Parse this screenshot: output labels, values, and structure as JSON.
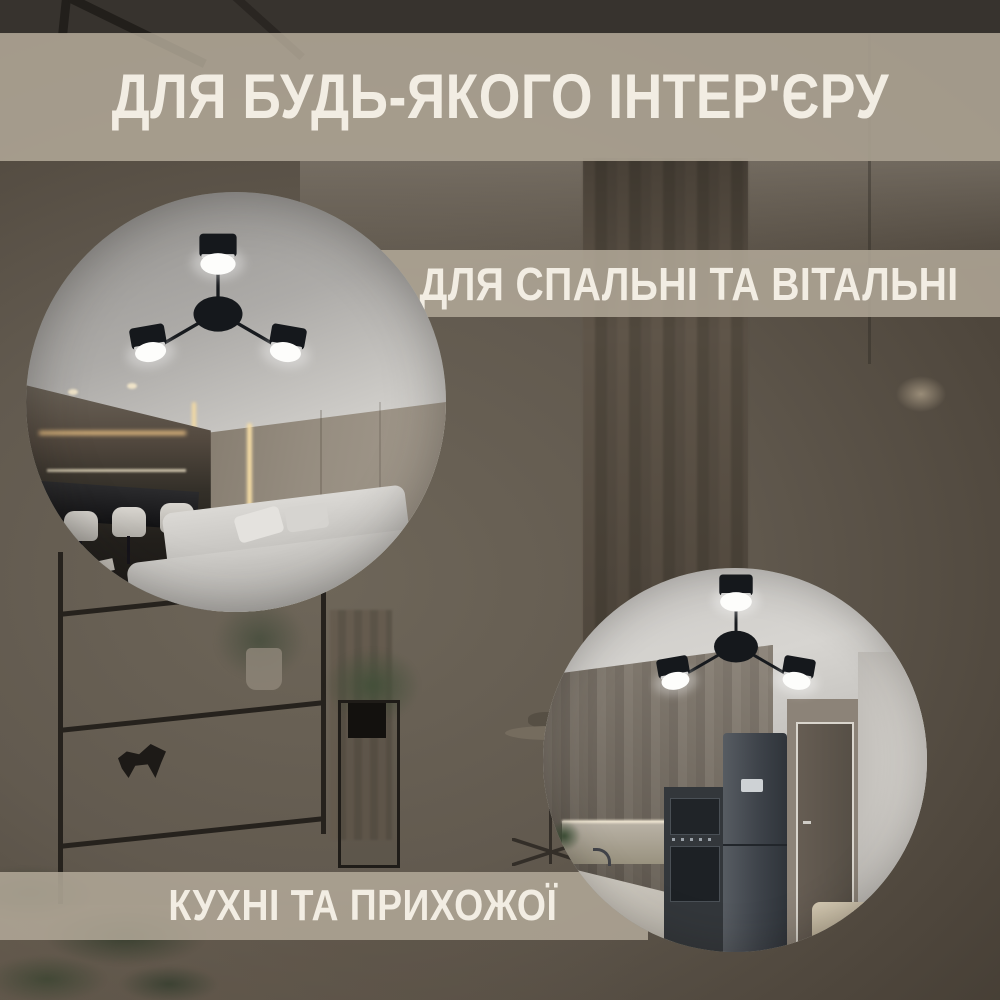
{
  "image": {
    "kind": "product-showcase-collage",
    "language": "uk",
    "product": "three-arm LED ceiling lamp, black, 3 round light heads"
  },
  "banners": {
    "header": {
      "label": "ДЛЯ БУДЬ-ЯКОГО ІНТЕР'ЄРУ"
    },
    "bedroom_living": {
      "label": "ДЛЯ СПАЛЬНІ ТА ВІТАЛЬНІ"
    },
    "kitchen_hallway": {
      "label": "КУХНІ ТА ПРИХОЖОЇ"
    }
  },
  "scenes": {
    "living_circle": {
      "content": "living room with corner sofa, bar stools and ceiling lamp"
    },
    "kitchen_circle": {
      "content": "kitchen with fridge, built-in ovens, door and ceiling lamp"
    }
  },
  "colors": {
    "banner_bg": "#B2A999",
    "banner_text": "#F2EDE3",
    "backdrop_dim": "#57504A",
    "lamp_black": "#15181C",
    "lamp_glow": "#FDFDFB"
  }
}
